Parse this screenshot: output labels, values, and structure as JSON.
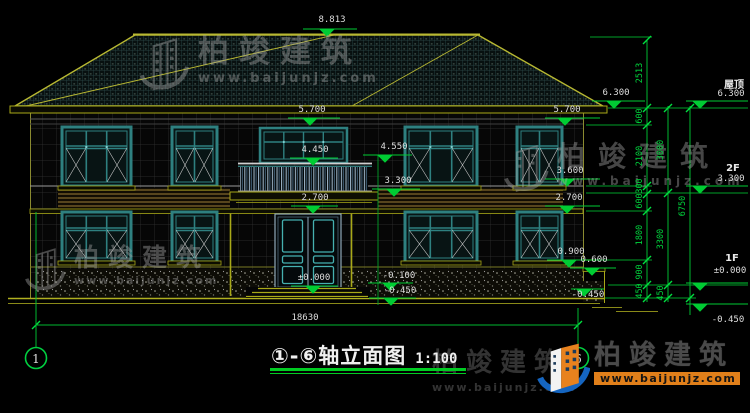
{
  "watermark": {
    "brand": "柏竣建筑",
    "url": "www.baijunjz.com"
  },
  "title": {
    "axes": "①-⑥",
    "text": "轴立面图",
    "scale": "1:100"
  },
  "axis_bubbles": {
    "left": "1",
    "right": "6"
  },
  "floor_labels": {
    "roof": "屋顶",
    "roof_level": "6.300",
    "second": "2F",
    "second_level": "3.300",
    "first": "1F",
    "first_level": "±0.000",
    "below_grade": "-0.450"
  },
  "elevation_marks": {
    "ridge": "8.813",
    "eave": "6.300",
    "win_head_left": "5.700",
    "win_head_right": "5.700",
    "balcony_win": "4.550",
    "balcony_rail": "4.450",
    "sill_2f": "3.600",
    "balcony_slab": "3.300",
    "door_head_left": "2.700",
    "door_head_right": "2.700",
    "sill_1f": "0.900",
    "side_step": "0.600",
    "ground_floor": "±0.000",
    "entry_step": "-0.100",
    "grade_mid": "-0.450",
    "grade_right": "-0.450"
  },
  "dim_chains": {
    "inner": [
      "2513",
      "600",
      "2100",
      "300",
      "600",
      "1800",
      "900",
      "450"
    ],
    "middle": [
      "3000",
      "3300",
      "450"
    ],
    "outer": [
      "6750"
    ],
    "total_width": "18630"
  }
}
